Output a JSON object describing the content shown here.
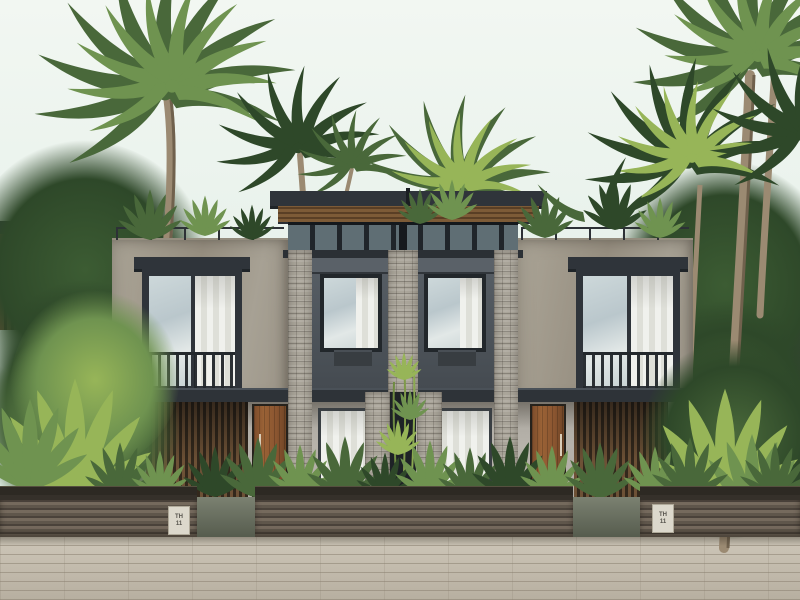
{
  "plaques": {
    "left": {
      "line1": "TH",
      "line2": "11"
    },
    "right": {
      "line1": "TH",
      "line2": "11"
    }
  },
  "palette": {
    "sky_top": "#f2f7f2",
    "sky_bottom": "#e2eee7",
    "roof": "#2f343a",
    "roof_edge": "#1f2428",
    "soffit_wood": "#7a5633",
    "clerestory": "#252a2e",
    "glass": "#c4d0d4",
    "curtain": "#edeeea",
    "charcoal_panel": "#4d545b",
    "concrete": "#a39d90",
    "stone": "#aaa59a",
    "canopy": "#2e3338",
    "door_wood": "#8a5532",
    "slat_wood": "#6d5136",
    "slat_gap": "#33281c",
    "ground_wall": "#b3afa7",
    "fence_light": "#756a5d",
    "fence_dark": "#4a423a",
    "fence_cap": "#35302a",
    "plaque_bg": "#dcd8cc",
    "plaque_text": "#55524b",
    "pavement_light": "#cfc8ba",
    "pavement_dark": "#b7afa0",
    "pavement_joint": "#8a8070",
    "walkway": "#6b7163",
    "foliage_dark": "#2e4829",
    "foliage_mid": "#49683a",
    "foliage_light": "#6f9350",
    "foliage_bright": "#97b558",
    "palm_trunk": "#9b8a72",
    "palm_trunk_dark": "#70614d"
  }
}
